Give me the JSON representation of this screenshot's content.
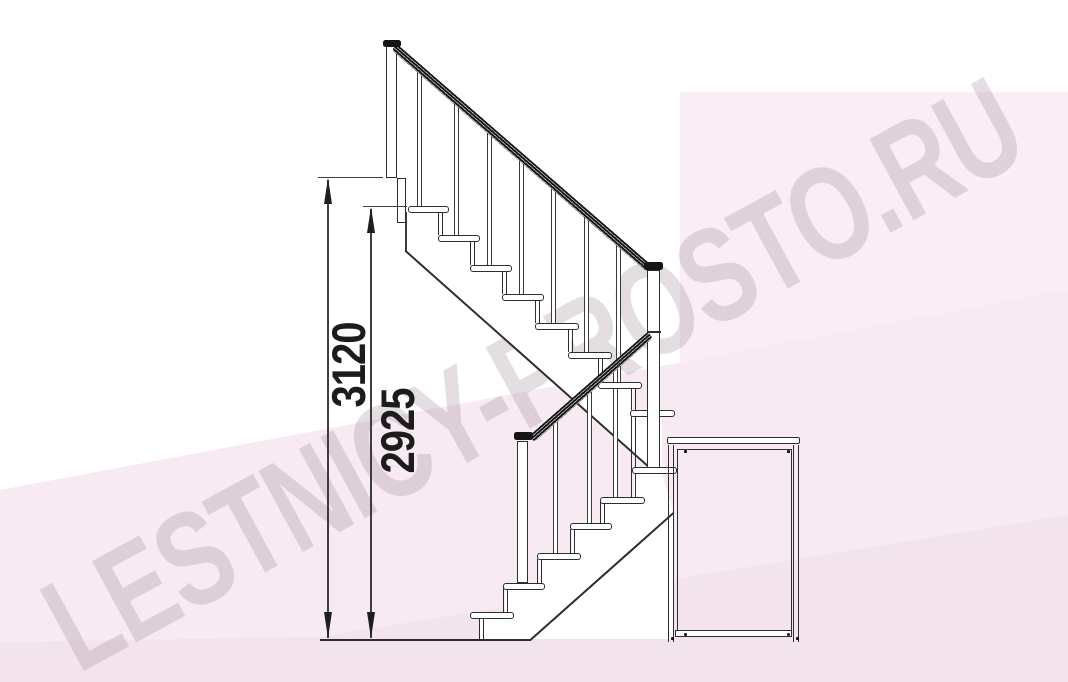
{
  "title": "staircase-side-elevation-drawing",
  "watermark": {
    "text": "LESTNICY-PROSTO.RU"
  },
  "dimensions": {
    "total_height": {
      "value": "3120"
    },
    "landing_height": {
      "value": "2925"
    }
  },
  "structure": {
    "upper_flight_treads": 8,
    "lower_flight_treads": 6,
    "posts": 4
  },
  "colors": {
    "line": "#2d2d2d",
    "rail": "#151515",
    "background": "#ffffff",
    "pink_panel": "#f9eef5",
    "pink_band": "#f7eaf2",
    "pink_deep": "#f3e3ed",
    "watermark_text": "rgba(154,132,148,0.27)"
  }
}
